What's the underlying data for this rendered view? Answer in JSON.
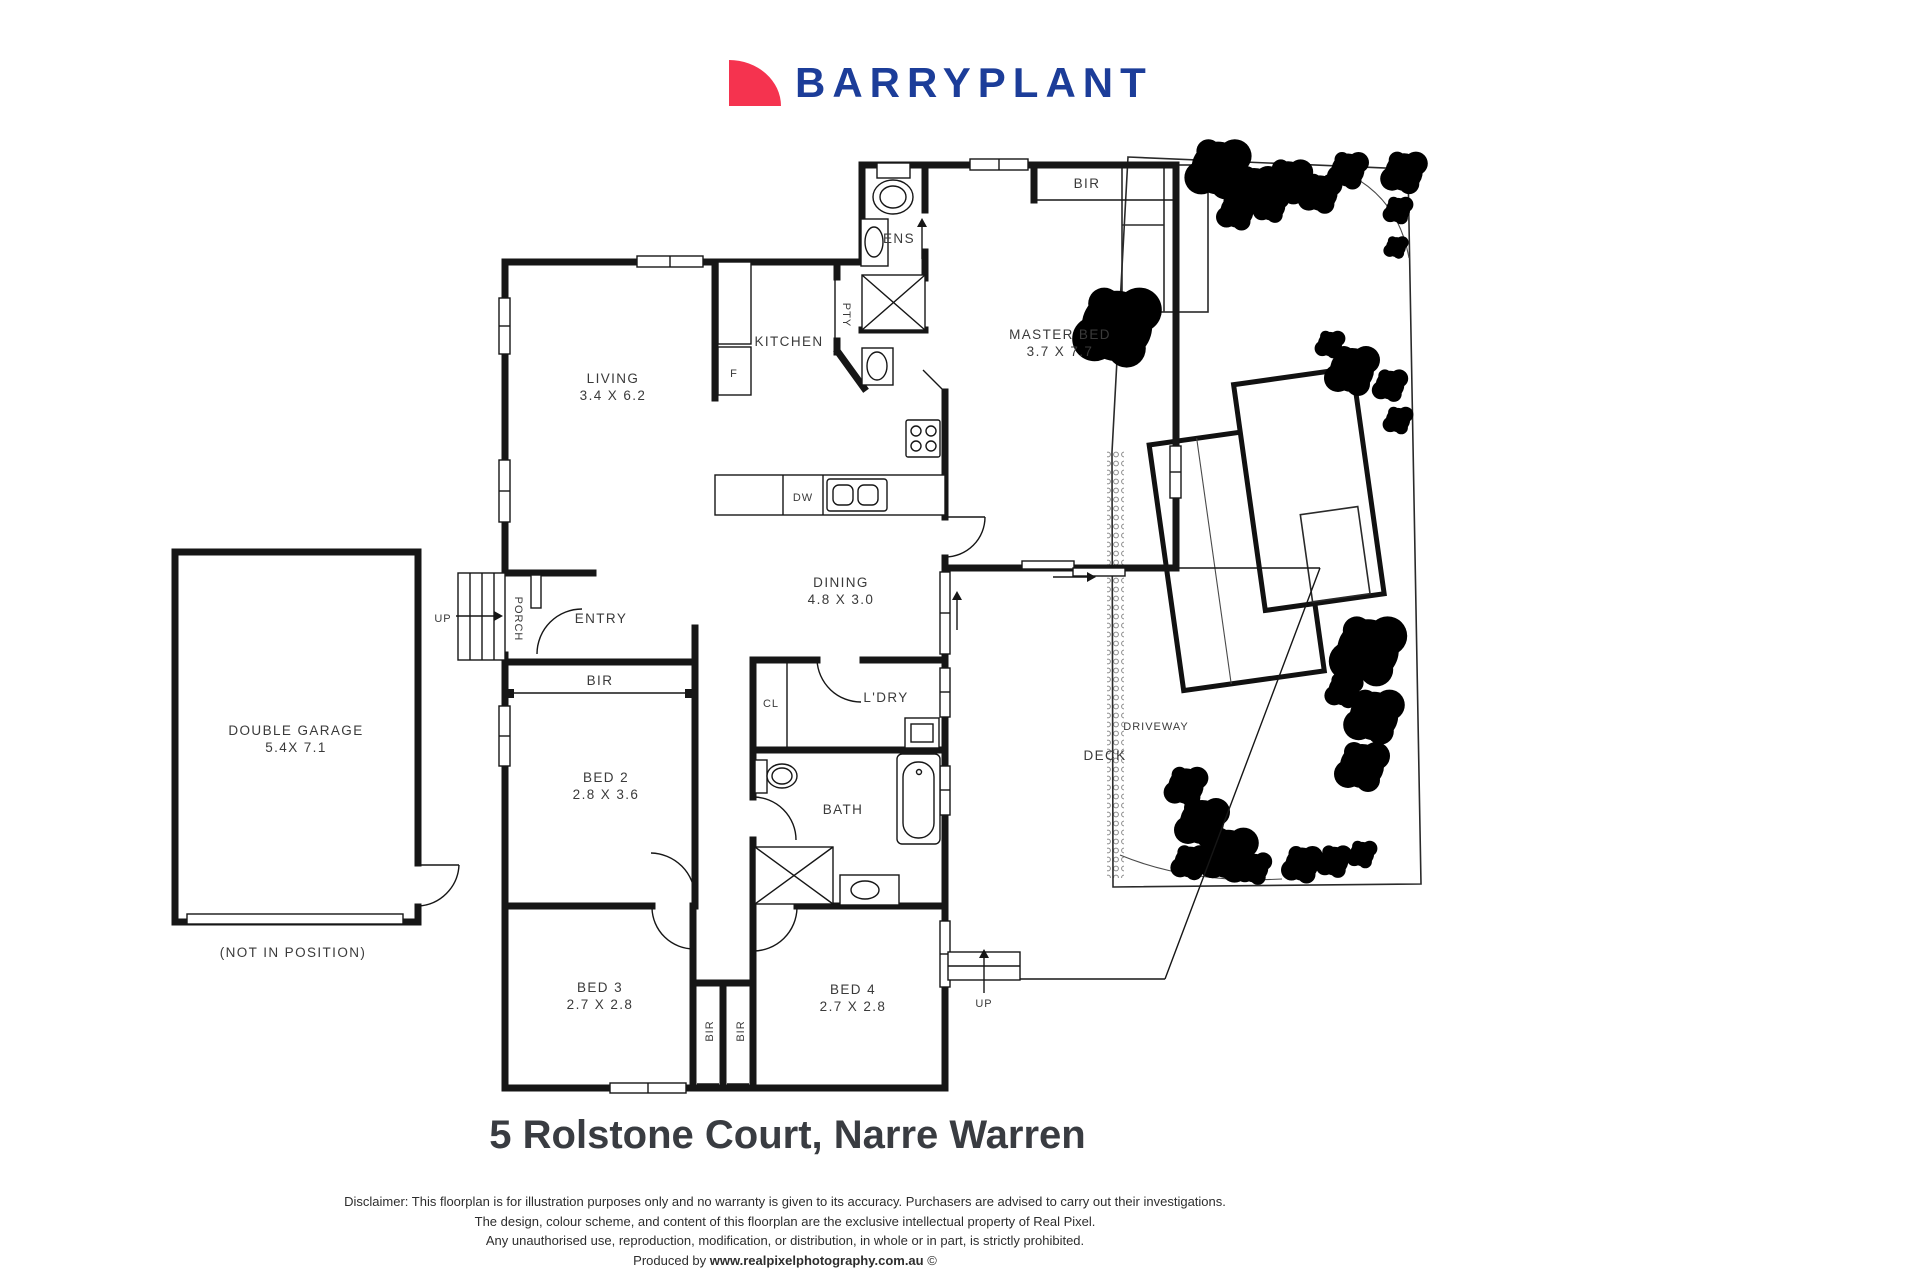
{
  "logo": {
    "text": "BARRYPLANT",
    "mark_color": "#F5334F",
    "text_color": "#1C3D99"
  },
  "title": "5 Rolstone Court, Narre Warren",
  "disclaimer": {
    "line1": "Disclaimer: This floorplan is for illustration purposes only and no warranty is given to its accuracy. Purchasers are advised to carry out their investigations.",
    "line2": "The design, colour scheme, and content of this floorplan are the exclusive intellectual property of Real Pixel.",
    "line3": "Any unauthorised use, reproduction, modification, or distribution, in whole or in part, is strictly prohibited.",
    "produced_prefix": "Produced by ",
    "produced_site": "www.realpixelphotography.com.au",
    "produced_suffix": " ©"
  },
  "floorplan": {
    "rooms": {
      "living": {
        "name": "LIVING",
        "dims": "3.4 X 6.2"
      },
      "kitchen": {
        "name": "KITCHEN"
      },
      "master": {
        "name": "MASTER BED",
        "dims": "3.7 X 7.7"
      },
      "dining": {
        "name": "DINING",
        "dims": "4.8 X 3.0"
      },
      "entry": {
        "name": "ENTRY"
      },
      "porch": {
        "name": "PORCH"
      },
      "ens": {
        "name": "ENS"
      },
      "laundry": {
        "name": "L'DRY"
      },
      "bath": {
        "name": "BATH"
      },
      "deck": {
        "name": "DECK"
      },
      "bed2": {
        "name": "BED 2",
        "dims": "2.8 X 3.6"
      },
      "bed3": {
        "name": "BED 3",
        "dims": "2.7 X 2.8"
      },
      "bed4": {
        "name": "BED 4",
        "dims": "2.7 X 2.8"
      },
      "garage": {
        "name": "DOUBLE GARAGE",
        "dims": "5.4X 7.1",
        "note": "(NOT IN POSITION)"
      }
    },
    "tags": {
      "bir": "BIR",
      "pty": "PTY",
      "cl": "CL",
      "fridge": "F",
      "dishwasher": "DW",
      "up": "UP"
    }
  },
  "siteplan": {
    "driveway": "DRIVEWAY"
  }
}
